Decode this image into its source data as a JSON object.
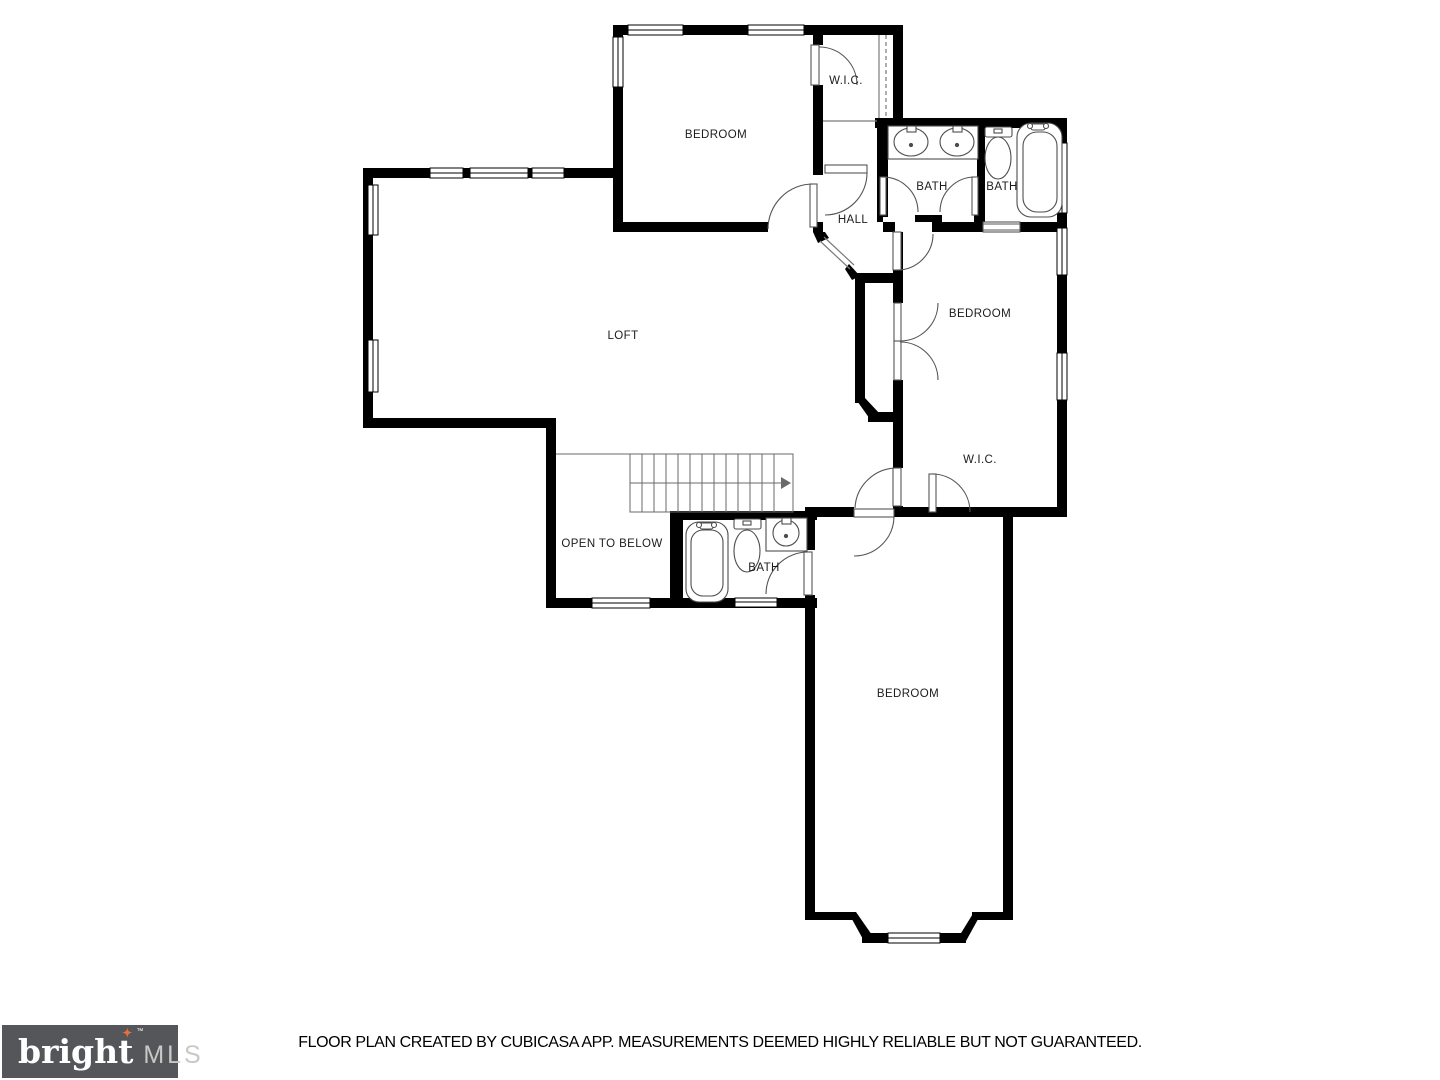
{
  "plan": {
    "rooms": [
      {
        "id": "wic-top",
        "label": "W.I.C."
      },
      {
        "id": "bedroom-top",
        "label": "BEDROOM"
      },
      {
        "id": "bath-jack-jill",
        "label": "BATH"
      },
      {
        "id": "bath-top-right",
        "label": "BATH"
      },
      {
        "id": "hall",
        "label": "HALL"
      },
      {
        "id": "loft",
        "label": "LOFT"
      },
      {
        "id": "bedroom-right",
        "label": "BEDROOM"
      },
      {
        "id": "wic-middle",
        "label": "W.I.C."
      },
      {
        "id": "open-to-below",
        "label": "OPEN TO BELOW"
      },
      {
        "id": "bath-bottom",
        "label": "BATH"
      },
      {
        "id": "bedroom-bottom",
        "label": "BEDROOM"
      }
    ]
  },
  "footer": {
    "disclaimer": "FLOOR PLAN CREATED BY CUBICASA APP. MEASUREMENTS DEEMED HIGHLY RELIABLE BUT NOT GUARANTEED."
  },
  "logo": {
    "brand": "bright",
    "star": "✦",
    "tm": "™",
    "suffix": "MLS"
  },
  "colors": {
    "wall": "#000000",
    "fixture_line": "#4d4d4d",
    "logo_bg": "#55565a",
    "logo_text": "#ffffff",
    "logo_mls": "#c8c9c7",
    "logo_star": "#e8713a"
  }
}
